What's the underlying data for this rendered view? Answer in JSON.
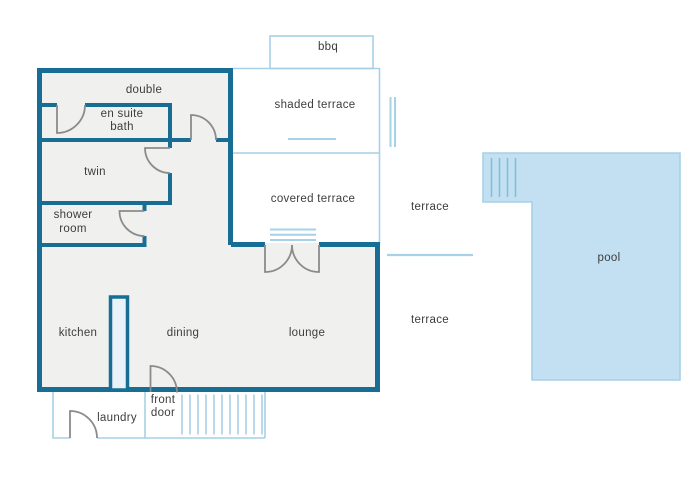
{
  "colors": {
    "wall": "#176d94",
    "outline_light": "#a6d1e6",
    "pool_fill": "#c3e0f2",
    "pool_steps": "#85bcd8",
    "interior_fill": "#f0f1ee",
    "island_fill": "#e9f2f9",
    "door_arc": "#8b8b8b",
    "text": "#3d3d3d"
  },
  "rooms": {
    "double": "double",
    "en_suite_bath_line1": "en suite",
    "en_suite_bath_line2": "bath",
    "twin": "twin",
    "shower_room_line1": "shower",
    "shower_room_line2": "room",
    "kitchen": "kitchen",
    "dining": "dining",
    "lounge": "lounge",
    "laundry": "laundry",
    "front_door_line1": "front",
    "front_door_line2": "door"
  },
  "outdoor": {
    "bbq": "bbq",
    "shaded_terrace": "shaded terrace",
    "covered_terrace": "covered terrace",
    "terrace_upper": "terrace",
    "terrace_lower": "terrace",
    "pool": "pool"
  }
}
